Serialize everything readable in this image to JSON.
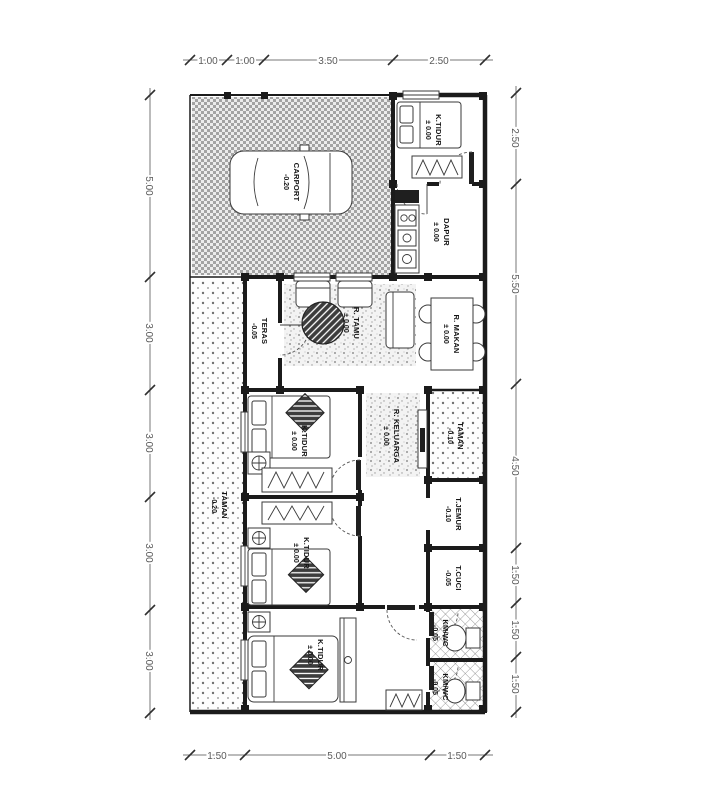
{
  "plan": {
    "dims": {
      "top": [
        "1.00",
        "1.00",
        "3.50",
        "2.50"
      ],
      "bottom": [
        "1.50",
        "5.00",
        "1.50"
      ],
      "left": [
        "5.00",
        "3.00",
        "3.00",
        "3.00",
        "3.00"
      ],
      "right": [
        "2.50",
        "5.50",
        "4.50",
        "1.50",
        "1.50",
        "1.50"
      ]
    },
    "rooms": {
      "carport": {
        "name": "CARPORT",
        "level": "-0.20"
      },
      "bedroom_top": {
        "name": "K.TIDUR",
        "level": "± 0.00"
      },
      "dapur": {
        "name": "DAPUR",
        "level": "± 0.00"
      },
      "teras": {
        "name": "TERAS",
        "level": "-0.05"
      },
      "tamu": {
        "name": "R. TAMU",
        "level": "± 0.00"
      },
      "makan": {
        "name": "R. MAKAN",
        "level": "± 0.00"
      },
      "keluarga": {
        "name": "R. KELUARGA",
        "level": "± 0.00"
      },
      "taman_kanan": {
        "name": "TAMAN",
        "level": "-0.10"
      },
      "taman_kiri": {
        "name": "TAMAN",
        "level": "-0.20"
      },
      "bedroom_mid": {
        "name": "K.TIDUR",
        "level": "± 0.00"
      },
      "bedroom_low": {
        "name": "K.TIDUR",
        "level": "± 0.00"
      },
      "bedroom_bottom": {
        "name": "K.TIDUR",
        "level": "± 0.00"
      },
      "jemur": {
        "name": "T.JEMUR",
        "level": "-0.10"
      },
      "cuci": {
        "name": "T.CUCI",
        "level": "-0.05"
      },
      "kmwc_atas": {
        "name": "KM/WC",
        "level": "-0.05"
      },
      "kmwc_bawah": {
        "name": "KM/WC",
        "level": "-0.05"
      }
    },
    "colors": {
      "wall": "#1b1b1b",
      "dim_text": "#5a5a5a",
      "paper": "#ffffff"
    }
  }
}
